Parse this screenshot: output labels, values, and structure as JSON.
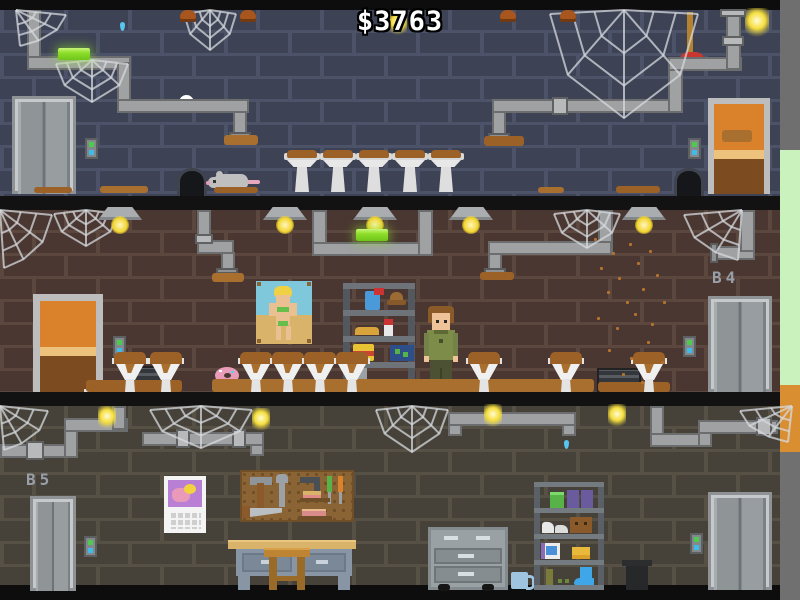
{
  "hud": {
    "money": "$3763"
  },
  "floors": {
    "b4_label": "B4",
    "b5_label": "B5"
  },
  "palette": {
    "wall_top": "#3d4254",
    "wall_mid": "#4a3731",
    "wall_bottom": "#46423a",
    "mortar_top": "#4c5268",
    "mortar_mid": "#5c473f",
    "mortar_bottom": "#565045",
    "band_black": "#121212",
    "pipe_grey": "#9fa1a2",
    "dirt_brown": "#9c6127",
    "tube_light_green": "#8ede2a",
    "money_text": "#ffffff",
    "label_grey": "#999fa8",
    "door_orange": "#d9822b",
    "elevator_grey": "#8f9497",
    "edge_green": "#c9f2bd",
    "edge_orange": "#d98e32",
    "edge_grey": "#6f6f6f",
    "call_button_green": "#4ecb4e",
    "call_button_blue": "#41b9ea"
  },
  "scene": {
    "walls": [
      {
        "id": "b3",
        "y": 10,
        "h": 186,
        "cls": "w1",
        "dash": "bd0"
      },
      {
        "id": "b4",
        "y": 210,
        "h": 182,
        "cls": "w2",
        "dash": "bd1"
      },
      {
        "id": "b5",
        "y": 406,
        "h": 179,
        "cls": "w3",
        "dash": "bd2"
      }
    ],
    "pipes": [
      [
        27,
        10,
        14,
        60
      ],
      [
        27,
        56,
        104,
        14
      ],
      [
        117,
        62,
        14,
        51
      ],
      [
        117,
        99,
        132,
        14
      ],
      [
        233,
        111,
        14,
        23
      ],
      [
        492,
        99,
        190,
        14
      ],
      [
        492,
        111,
        14,
        24
      ],
      [
        668,
        62,
        15,
        51
      ],
      [
        668,
        57,
        74,
        14
      ],
      [
        726,
        10,
        15,
        60
      ],
      [
        197,
        210,
        14,
        44
      ],
      [
        197,
        240,
        37,
        14
      ],
      [
        221,
        252,
        14,
        18
      ],
      [
        312,
        210,
        15,
        46
      ],
      [
        312,
        242,
        121,
        14
      ],
      [
        418,
        210,
        15,
        46
      ],
      [
        598,
        210,
        15,
        44
      ],
      [
        488,
        241,
        124,
        14
      ],
      [
        488,
        253,
        14,
        17
      ],
      [
        716,
        246,
        39,
        14
      ],
      [
        740,
        210,
        15,
        42
      ],
      [
        0,
        444,
        78,
        14
      ],
      [
        64,
        424,
        14,
        34
      ],
      [
        64,
        418,
        64,
        14
      ],
      [
        112,
        406,
        14,
        24
      ],
      [
        142,
        432,
        122,
        14
      ],
      [
        250,
        444,
        14,
        12
      ],
      [
        448,
        412,
        128,
        14
      ],
      [
        448,
        424,
        14,
        12
      ],
      [
        562,
        424,
        14,
        12
      ],
      [
        650,
        406,
        14,
        38
      ],
      [
        650,
        433,
        62,
        14
      ],
      [
        698,
        422,
        14,
        25
      ],
      [
        698,
        420,
        80,
        14
      ]
    ],
    "sleeves": [
      [
        722,
        36,
        22,
        10
      ],
      [
        720,
        9,
        26,
        8
      ],
      [
        552,
        97,
        16,
        18
      ],
      [
        195,
        234,
        18,
        10
      ],
      [
        26,
        441,
        18,
        19
      ],
      [
        176,
        429,
        14,
        19
      ],
      [
        232,
        429,
        14,
        19
      ],
      [
        756,
        417,
        16,
        19
      ]
    ],
    "flares": [
      [
        229,
        132,
        22,
        6
      ],
      [
        488,
        133,
        22,
        6
      ],
      [
        216,
        268,
        22,
        6
      ],
      [
        484,
        268,
        22,
        6
      ],
      [
        710,
        243,
        8,
        20
      ]
    ],
    "dirt": [
      [
        34,
        187,
        38,
        6
      ],
      [
        100,
        186,
        48,
        7
      ],
      [
        214,
        187,
        44,
        6
      ],
      [
        538,
        187,
        26,
        6
      ],
      [
        616,
        186,
        44,
        7
      ],
      [
        224,
        135,
        34,
        10
      ],
      [
        484,
        136,
        40,
        10
      ],
      [
        722,
        130,
        30,
        12
      ],
      [
        86,
        380,
        96,
        12
      ],
      [
        212,
        379,
        382,
        13
      ],
      [
        598,
        382,
        72,
        10
      ],
      [
        212,
        273,
        32,
        9
      ],
      [
        480,
        272,
        34,
        8
      ]
    ],
    "webs": [
      [
        16,
        10,
        50,
        36,
        "tl"
      ],
      [
        56,
        60,
        72,
        42,
        "tc"
      ],
      [
        184,
        10,
        52,
        40,
        "tc"
      ],
      [
        550,
        10,
        148,
        108,
        "tc"
      ],
      [
        0,
        210,
        52,
        58,
        "tl"
      ],
      [
        54,
        210,
        64,
        36,
        "tc"
      ],
      [
        554,
        210,
        66,
        38,
        "tc"
      ],
      [
        684,
        210,
        58,
        50,
        "tr"
      ],
      [
        0,
        406,
        48,
        44,
        "tl"
      ],
      [
        150,
        406,
        102,
        42,
        "tc"
      ],
      [
        376,
        406,
        72,
        46,
        "tc"
      ],
      [
        740,
        406,
        52,
        36,
        "tr"
      ]
    ],
    "toilets": {
      "y": 150,
      "xs": [
        284,
        320,
        356,
        392,
        428
      ]
    },
    "funnels": {
      "y": 352,
      "xs": [
        112,
        148,
        238,
        270,
        302,
        334,
        466,
        548,
        631
      ]
    },
    "lamps": {
      "y": 207,
      "cxs": [
        120,
        285,
        375,
        471,
        644
      ]
    },
    "fixtures": {
      "y": 10,
      "xs": [
        180,
        240,
        500,
        560
      ]
    },
    "greenlights": [
      [
        58,
        48
      ],
      [
        356,
        229
      ]
    ],
    "glows": [
      [
        98,
        406
      ],
      [
        252,
        408
      ],
      [
        484,
        404
      ],
      [
        608,
        404
      ],
      [
        389,
        12
      ]
    ],
    "flies": [
      [
        594,
        238
      ],
      [
        612,
        252
      ],
      [
        629,
        243
      ],
      [
        600,
        267
      ],
      [
        618,
        277
      ],
      [
        637,
        262
      ],
      [
        649,
        250
      ],
      [
        607,
        291
      ],
      [
        626,
        301
      ],
      [
        642,
        288
      ],
      [
        656,
        274
      ],
      [
        597,
        317
      ],
      [
        616,
        327
      ],
      [
        634,
        313
      ],
      [
        651,
        323
      ],
      [
        663,
        301
      ],
      [
        608,
        349
      ],
      [
        630,
        357
      ],
      [
        647,
        341
      ],
      [
        661,
        361
      ],
      [
        622,
        373
      ],
      [
        641,
        381
      ]
    ],
    "drips": [
      [
        120,
        22
      ],
      [
        564,
        440
      ]
    ]
  }
}
